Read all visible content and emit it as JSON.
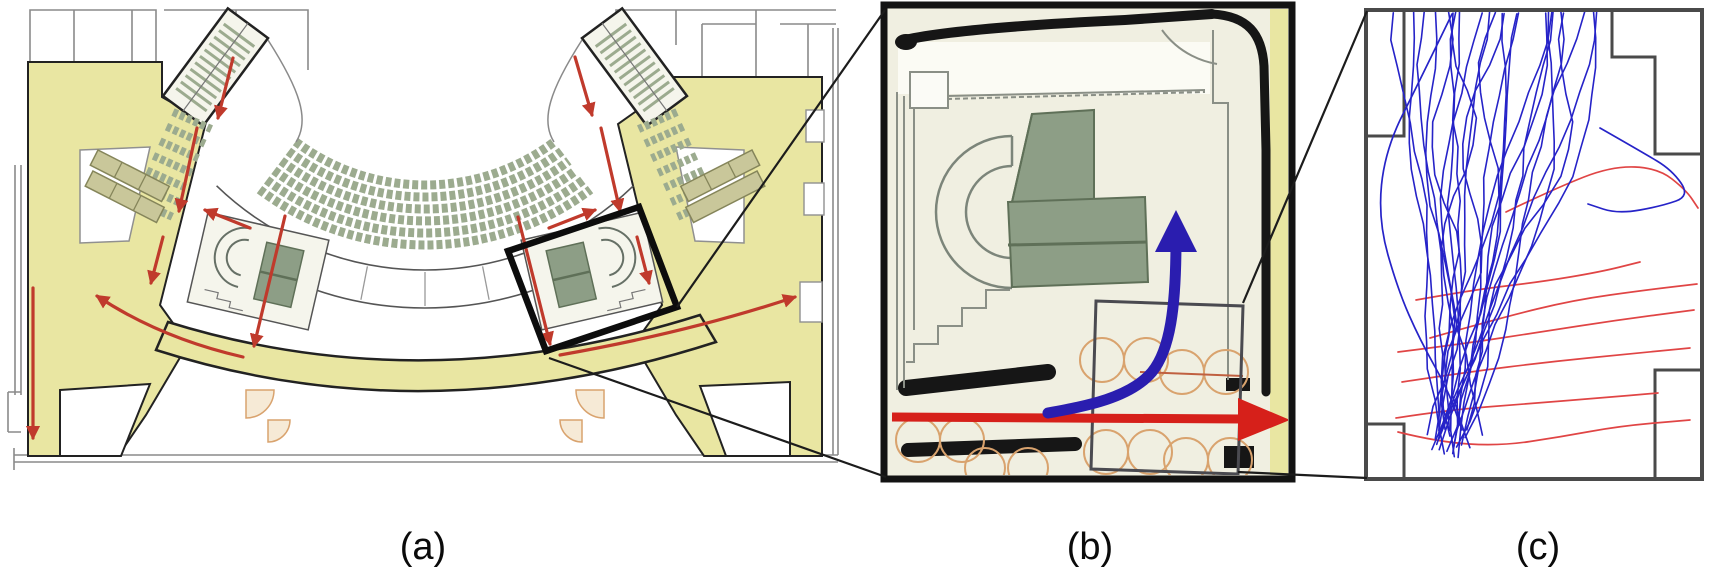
{
  "figure": {
    "description": "Three-panel figure: (a) theatre balcony floor plan with egress routes, (b) magnified stairwell detail with flow arrows, (c) recorded pedestrian trajectories in the stair lobby",
    "captions": {
      "a": "(a)",
      "b": "(b)",
      "c": "(c)"
    }
  },
  "colors": {
    "corridor_yellow": "#e9e6a2",
    "seat_sage": "#9cab8f",
    "stair_green": "#8d9e86",
    "stair_green_dark": "#5f7058",
    "wall_black": "#1a1a1a",
    "thin_wall_gray": "#8a8a8a",
    "egress_red": "#c03a2c",
    "detail_red_arrow": "#d6201a",
    "detail_blue_arrow": "#2a1daf",
    "furniture_tan": "#d9a36e",
    "trajectory_blue": "#2623c8",
    "trajectory_red": "#e04545",
    "room_outline_gray": "#4a4a4a"
  },
  "panel_a": {
    "description": "balcony-level theatre floor plan, red arrows = egress flow",
    "egress_arrows": [
      {
        "from": [
          233,
          58
        ],
        "to": [
          218,
          118
        ]
      },
      {
        "from": [
          575,
          57
        ],
        "to": [
          592,
          115
        ]
      },
      {
        "from": [
          197,
          128
        ],
        "to": [
          179,
          211
        ]
      },
      {
        "from": [
          601,
          128
        ],
        "to": [
          620,
          211
        ]
      },
      {
        "from": [
          250,
          228
        ],
        "to": [
          205,
          210
        ]
      },
      {
        "from": [
          549,
          228
        ],
        "to": [
          595,
          210
        ]
      },
      {
        "from": [
          285,
          216
        ],
        "to": [
          254,
          346
        ]
      },
      {
        "from": [
          518,
          217
        ],
        "to": [
          550,
          344
        ]
      },
      {
        "from": [
          163,
          237
        ],
        "to": [
          151,
          283
        ]
      },
      {
        "from": [
          637,
          237
        ],
        "to": [
          649,
          283
        ]
      },
      {
        "from": [
          243,
          357
        ],
        "ctrl": [
          160,
          338
        ],
        "to": [
          97,
          296
        ]
      },
      {
        "from": [
          560,
          355
        ],
        "ctrl": [
          690,
          332
        ],
        "to": [
          795,
          297
        ]
      },
      {
        "from": [
          33,
          288
        ],
        "to": [
          33,
          438
        ]
      }
    ]
  },
  "panel_b": {
    "description": "zoomed stairwell plan",
    "red_arrow_meaning": "corridor through-flow",
    "blue_arrow_meaning": "flow turning up the stairs"
  },
  "panel_c": {
    "description": "tracked pedestrian trajectories in stair lobby",
    "blue_trajectory_count": 24,
    "red_trajectory_count": 7,
    "seed": 11,
    "blue_special_paths": [
      [
        [
          1600,
          128
        ],
        [
          1642,
          152
        ],
        [
          1672,
          170
        ],
        [
          1690,
          196
        ],
        [
          1662,
          206
        ],
        [
          1618,
          214
        ],
        [
          1588,
          204
        ]
      ],
      [
        [
          1452,
          14
        ],
        [
          1420,
          80
        ],
        [
          1385,
          150
        ],
        [
          1378,
          220
        ],
        [
          1398,
          290
        ],
        [
          1420,
          340
        ],
        [
          1448,
          390
        ],
        [
          1462,
          430
        ]
      ]
    ],
    "red_paths": [
      [
        [
          1506,
          212
        ],
        [
          1556,
          188
        ],
        [
          1612,
          166
        ],
        [
          1658,
          168
        ],
        [
          1686,
          190
        ],
        [
          1698,
          208
        ]
      ],
      [
        [
          1430,
          338
        ],
        [
          1500,
          318
        ],
        [
          1574,
          300
        ],
        [
          1646,
          290
        ],
        [
          1697,
          284
        ]
      ],
      [
        [
          1398,
          352
        ],
        [
          1462,
          344
        ],
        [
          1540,
          332
        ],
        [
          1618,
          320
        ],
        [
          1694,
          310
        ]
      ],
      [
        [
          1402,
          382
        ],
        [
          1468,
          372
        ],
        [
          1548,
          362
        ],
        [
          1628,
          354
        ],
        [
          1690,
          348
        ]
      ],
      [
        [
          1396,
          418
        ],
        [
          1448,
          410
        ],
        [
          1524,
          404
        ],
        [
          1600,
          398
        ],
        [
          1658,
          393
        ]
      ],
      [
        [
          1398,
          432
        ],
        [
          1438,
          442
        ],
        [
          1500,
          446
        ],
        [
          1560,
          437
        ],
        [
          1620,
          426
        ],
        [
          1690,
          420
        ]
      ],
      [
        [
          1416,
          300
        ],
        [
          1472,
          290
        ],
        [
          1540,
          282
        ],
        [
          1600,
          272
        ],
        [
          1640,
          262
        ]
      ]
    ]
  }
}
